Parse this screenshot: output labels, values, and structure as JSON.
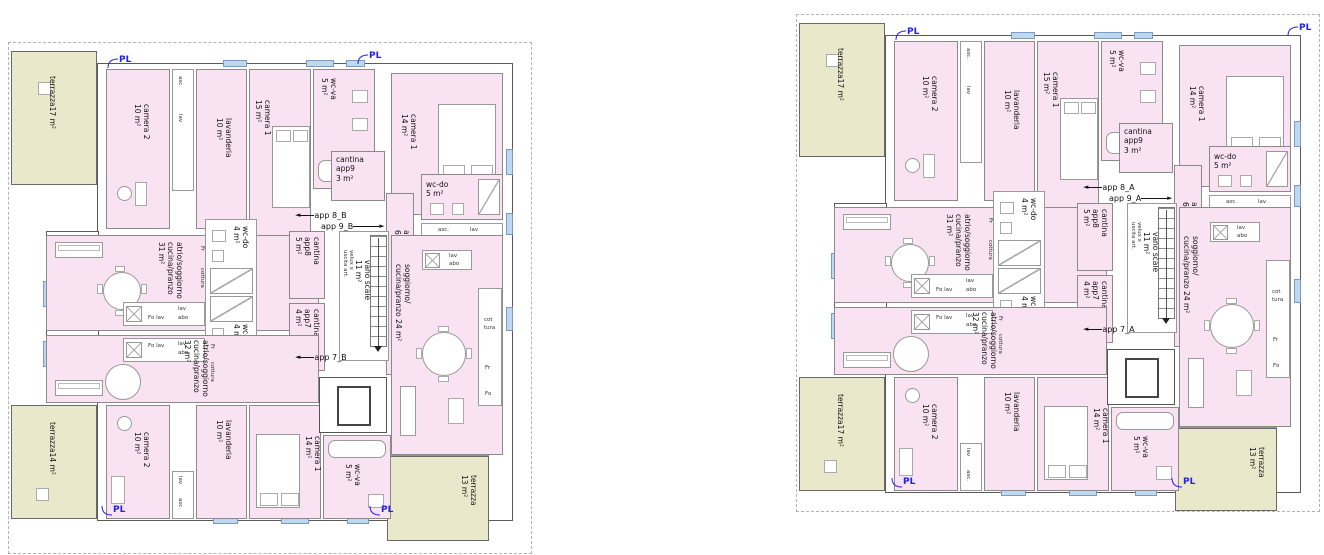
{
  "icons": {
    "arrow_left": "◄",
    "arrow_right": "►",
    "pl_leader": "curved-leader"
  },
  "colors": {
    "room_fill": "#f9e3f3",
    "terrace_fill": "#eae8cb",
    "window_fill": "#bdd8f0",
    "pl_blue": "#2222ee"
  },
  "plans": [
    {
      "pl": "PL",
      "terraces": {
        "top_left": "terrazza17 m²",
        "bottom_left": "terrazza14 m²",
        "bottom_right_1": "terrazza",
        "bottom_right_2": "13 m²"
      },
      "entrances": {
        "app8": "app 8_B",
        "app9": "app 9_B",
        "app7": "app 7_B"
      },
      "rooms": {
        "camera2_top_1": "camera 2",
        "camera2_top_2": "10 m²",
        "shaft_top_1": "asc.",
        "shaft_top_2": "lav",
        "lavanderia_top_1": "lavanderia",
        "lavanderia_top_2": "10 m²",
        "camera1_15_1": "camera 1",
        "camera1_15_2": "15 m²",
        "wcva_top_1": "wc-va",
        "wcva_top_2": "5 m²",
        "camera1_14_top_1": "camera 1",
        "camera1_14_top_2": "14 m²",
        "cantina9_1": "cantina",
        "cantina9_2": "app9",
        "cantina9_3": "3 m²",
        "wcdo5_1": "wc-do",
        "wcdo5_2": "5 m²",
        "asclav_1": "asc.",
        "asclav_2": "lav",
        "lav7_1": "lavanderia",
        "lav7_2": "7 m²",
        "corr6_1": "atrio/corr",
        "corr6_2": "6 m²",
        "living31_1": "atrio/soggiorno",
        "living31_2": "cucina/pranzo",
        "living31_3": "31 m²",
        "wcdo4a_1": "wc-do",
        "wcdo4a_2": "4 m²",
        "wcdo4b_1": "wc-do",
        "wcdo4b_2": "4 m²",
        "cantina8_1": "cantina",
        "cantina8_2": "app8",
        "cantina8_3": "5 m²",
        "cantina7_1": "cantina",
        "cantina7_2": "app7",
        "cantina7_3": "4 m²",
        "velux_1": "velux x",
        "velux_2": "uscita art.",
        "stair_1": "vano scale",
        "stair_2": "11 m²",
        "living24_1": "soggiorno/",
        "living24_2": "cucina/pranzo 24 m²",
        "living32_1": "atrio/soggiorno",
        "living32_2": "cucina/pranzo",
        "living32_3": "32 m²",
        "camera2_bot_1": "camera 2",
        "camera2_bot_2": "10 m²",
        "shaft_bot_1": "lav",
        "shaft_bot_2": "asc.",
        "lavanderia_bot_1": "lavanderia",
        "lavanderia_bot_2": "10 m²",
        "camera1_14_bot_1": "camera 1",
        "camera1_14_bot_2": "14 m²",
        "wcva_bot_1": "wc-va",
        "wcva_bot_2": "5 m²",
        "k31_folav": "Fo lav",
        "k31_lav": "lav",
        "k31_abo": "abo",
        "k31_cottura": "cottura",
        "k31_fr": "Fr",
        "k32_folav": "Fo lav",
        "k32_lav": "lav",
        "k32_abo": "abo",
        "k32_cottura": "cottura",
        "k32_fr": "Fr",
        "k24_lav": "lav",
        "k24_abo": "abo",
        "k24_cot": "cot",
        "k24_tura": "tura",
        "k24_fr": "Fr",
        "k24_fo": "Fo"
      }
    },
    {
      "pl": "PL",
      "terraces": {
        "top_left": "terrazza17 m²",
        "bottom_left": "terrazza17 m²",
        "bottom_right_1": "terrazza",
        "bottom_right_2": "13 m²"
      },
      "entrances": {
        "app8": "app 8_A",
        "app9": "app 9_A",
        "app7": "app 7_A"
      },
      "rooms": {
        "camera2_top_1": "camera 2",
        "camera2_top_2": "10 m²",
        "shaft_top_1": "asc.",
        "shaft_top_2": "lav",
        "lavanderia_top_1": "lavanderia",
        "lavanderia_top_2": "10 m²",
        "camera1_15_1": "camera 1",
        "camera1_15_2": "15 m²",
        "wcva_top_1": "wc-va",
        "wcva_top_2": "5 m²",
        "camera1_14_top_1": "camera 1",
        "camera1_14_top_2": "14 m²",
        "cantina9_1": "cantina",
        "cantina9_2": "app9",
        "cantina9_3": "3 m²",
        "wcdo5_1": "wc-do",
        "wcdo5_2": "5 m²",
        "asclav_1": "asc.",
        "asclav_2": "lav",
        "lav7_1": "lavanderia",
        "lav7_2": "7 m²",
        "corr6_1": "atrio/corr",
        "corr6_2": "6 m²",
        "living31_1": "atrio/soggiorno",
        "living31_2": "cucina/pranzo",
        "living31_3": "31 m²",
        "wcdo4a_1": "wc-do",
        "wcdo4a_2": "4 m²",
        "wcdo4b_1": "wc-do",
        "wcdo4b_2": "4 m²",
        "cantina8_1": "cantina",
        "cantina8_2": "app8",
        "cantina8_3": "5 m²",
        "cantina7_1": "cantina",
        "cantina7_2": "app7",
        "cantina7_3": "4 m²",
        "velux_1": "velux x",
        "velux_2": "uscita art.",
        "stair_1": "vano scale",
        "stair_2": "11 m²",
        "living24_1": "soggiorno/",
        "living24_2": "cucina/pranzo 24 m²",
        "living32_1": "atrio/soggiorno",
        "living32_2": "cucina/pranzo",
        "living32_3": "32 m²",
        "camera2_bot_1": "camera 2",
        "camera2_bot_2": "10 m²",
        "shaft_bot_1": "lav",
        "shaft_bot_2": "asc.",
        "lavanderia_bot_1": "lavanderia",
        "lavanderia_bot_2": "10 m²",
        "camera1_14_bot_1": "camera 1",
        "camera1_14_bot_2": "14 m²",
        "wcva_bot_1": "wc-va",
        "wcva_bot_2": "5 m²",
        "k31_folav": "Fo lav",
        "k31_lav": "lav",
        "k31_abo": "abo",
        "k31_cottura": "cottura",
        "k31_fr": "Fr",
        "k32_folav": "Fo lav",
        "k32_lav": "lav",
        "k32_abo": "abo",
        "k32_cottura": "cottura",
        "k32_fr": "Fr",
        "k24_lav": "lav",
        "k24_abo": "abo",
        "k24_cot": "cot",
        "k24_tura": "tura",
        "k24_fr": "Fr",
        "k24_fo": "Fo"
      }
    }
  ]
}
